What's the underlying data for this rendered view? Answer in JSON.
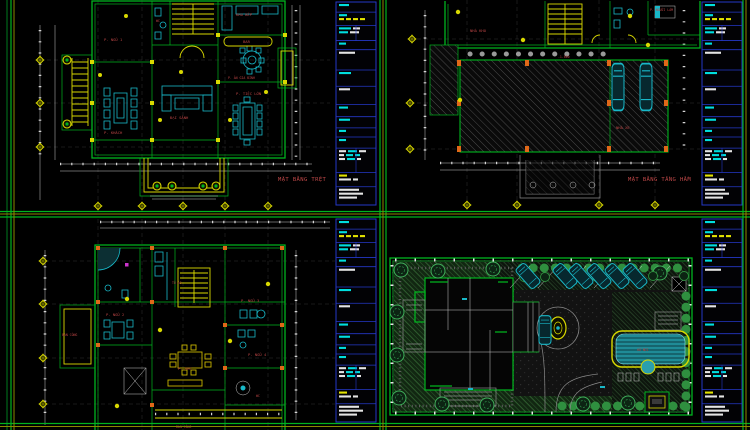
{
  "app": {
    "background": "#000000"
  },
  "colors": {
    "wall_green": "#00b41e",
    "yellow": "#d9d900",
    "olive": "#8a8a00",
    "furniture_cyan": "#18b8c8",
    "label_red": "#b94444",
    "legend_blue": "#2438c8",
    "column_orange": "#e06818",
    "dim_white": "#c9c9c9",
    "pool_cyan": "#1f8b96",
    "lawn_green": "#2e5c2e"
  },
  "sheets": {
    "ground_floor": {
      "title": "MẶT BẰNG TRỆT",
      "labels": {
        "bedroom1": "P. NGỦ 1",
        "wc": "WC",
        "kitchen": "KHU BẾP",
        "bar": "BAR",
        "family_dining": "P. ĂN GIA ĐÌNH",
        "banquet": "P. TIỆC LỚN",
        "hall": "ĐẠI SẢNH",
        "living": "P. KHÁCH"
      }
    },
    "basement": {
      "title": "MẶT BẰNG TẦNG HẦM",
      "labels": {
        "storage": "NHÀ KHO",
        "maid": "P. NGƯỜI LÀM",
        "level": "-1.600",
        "garage": "NHÀ XE"
      }
    },
    "upper_floor": {
      "labels": {
        "bedroom2": "P. NGỦ 2",
        "bedroom3": "P. NGỦ 3",
        "bedroom4": "P. NGỦ 4",
        "family": "P. SHC",
        "wardrobe": "TỦ ÁO",
        "wc": "WC",
        "balcony_left": "BAN CÔNG",
        "balcony_bottom": "BAN CÔNG"
      }
    },
    "site_plan": {
      "labels": {
        "pool": "HỒ BƠI"
      }
    }
  },
  "legend": {
    "border_color": "#2438c8",
    "bar_colors": {
      "c": "#00dede",
      "w": "#e4e4e4",
      "y": "#e3e300"
    },
    "strips": [
      {
        "x": 336,
        "y": 2,
        "w": 40,
        "h": 203
      },
      {
        "x": 702,
        "y": 2,
        "w": 40,
        "h": 203
      },
      {
        "x": 336,
        "y": 219,
        "w": 40,
        "h": 203
      },
      {
        "x": 702,
        "y": 219,
        "w": 40,
        "h": 203
      }
    ],
    "sections": [
      {
        "h": 10,
        "rows": [
          [
            [
              "c",
              10
            ]
          ]
        ]
      },
      {
        "h": 13,
        "rows": [
          [
            [
              "c",
              8
            ]
          ],
          [
            [
              "y",
              5
            ],
            [
              "y",
              5
            ],
            [
              "y",
              5
            ],
            [
              "y",
              5
            ]
          ]
        ]
      },
      {
        "h": 15,
        "grid": true,
        "rows": [
          [
            [
              "c",
              12
            ],
            [
              "w",
              7
            ]
          ],
          [
            [
              "c",
              9
            ],
            [
              "w",
              9
            ]
          ]
        ]
      },
      {
        "h": 9,
        "rows": [
          [
            [
              "c",
              7
            ]
          ]
        ]
      },
      {
        "h": 20,
        "rows": [
          [
            [
              "w",
              16
            ]
          ]
        ]
      },
      {
        "h": 16,
        "rows": [
          [
            [
              "c",
              12
            ]
          ]
        ]
      },
      {
        "h": 18,
        "rows": [
          [
            [
              "w",
              11
            ]
          ]
        ]
      },
      {
        "h": 12,
        "rows": [
          [
            [
              "c",
              9
            ]
          ]
        ]
      },
      {
        "h": 11,
        "rows": [
          [
            [
              "c",
              11
            ]
          ]
        ]
      },
      {
        "h": 9,
        "rows": [
          [
            [
              "c",
              7
            ]
          ]
        ]
      },
      {
        "h": 11,
        "rows": [
          [
            [
              "c",
              7
            ]
          ]
        ]
      },
      {
        "h": 24,
        "grid": true,
        "rows": [
          [
            [
              "w",
              7
            ],
            [
              "c",
              9
            ],
            [
              "w",
              7
            ]
          ],
          [
            [
              "w",
              5
            ],
            [
              "c",
              7
            ],
            [
              "c",
              5
            ]
          ],
          [
            [
              "w",
              6
            ],
            [
              "c",
              8
            ],
            [
              "w",
              4
            ]
          ]
        ]
      },
      {
        "h": 14,
        "rows": [
          [
            [
              "y",
              8
            ]
          ],
          [
            [
              "w",
              12
            ],
            [
              "w",
              5
            ]
          ]
        ]
      },
      {
        "h": 18,
        "rows": [
          [
            [
              "w",
              20
            ]
          ],
          [
            [
              "w",
              24
            ]
          ],
          [
            [
              "w",
              18
            ]
          ]
        ]
      }
    ]
  },
  "grid_diamonds": [
    [
      40,
      60
    ],
    [
      40,
      103
    ],
    [
      40,
      147
    ],
    [
      98,
      206
    ],
    [
      142,
      206
    ],
    [
      183,
      206
    ],
    [
      225,
      206
    ],
    [
      268,
      206
    ],
    [
      412,
      39
    ],
    [
      410,
      103
    ],
    [
      410,
      149
    ],
    [
      467,
      205
    ],
    [
      517,
      205
    ],
    [
      599,
      205
    ],
    [
      655,
      205
    ],
    [
      43,
      261
    ],
    [
      43,
      304
    ],
    [
      43,
      358
    ],
    [
      43,
      404
    ]
  ],
  "site": {
    "trees": [
      [
        401,
        270
      ],
      [
        438,
        271
      ],
      [
        493,
        269
      ],
      [
        397,
        312
      ],
      [
        397,
        355
      ],
      [
        399,
        398
      ],
      [
        442,
        404
      ],
      [
        487,
        405
      ],
      [
        583,
        404
      ],
      [
        628,
        403
      ],
      [
        660,
        273
      ]
    ],
    "bushes": [
      [
        524,
        277
      ],
      [
        545,
        277
      ],
      [
        597,
        277
      ],
      [
        653,
        276
      ],
      [
        684,
        276
      ]
    ],
    "cars": [
      [
        528,
        276,
        -42,
        1
      ],
      [
        565,
        276,
        -42,
        1
      ],
      [
        581,
        276,
        -42,
        1
      ],
      [
        599,
        276,
        -42,
        1
      ],
      [
        617,
        276,
        -42,
        1
      ],
      [
        635,
        276,
        -42,
        1
      ],
      [
        545,
        330,
        0,
        1.1
      ],
      [
        618,
        87,
        0,
        1.8
      ],
      [
        646,
        87,
        0,
        1.8
      ]
    ]
  }
}
